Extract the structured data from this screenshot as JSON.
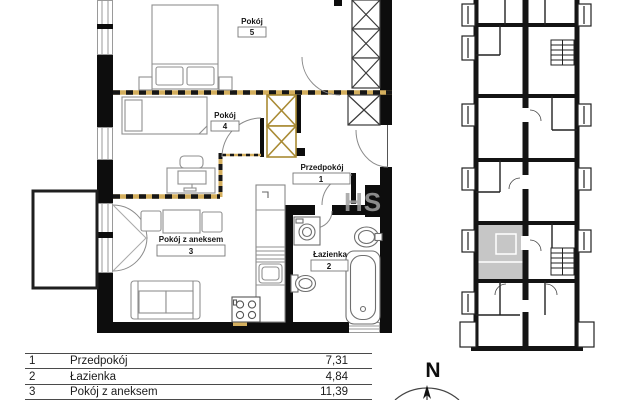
{
  "plan": {
    "rooms": [
      {
        "name": "Pokój",
        "number": "5"
      },
      {
        "name": "Pokój",
        "number": "4"
      },
      {
        "name": "Przedpokój",
        "number": "1"
      },
      {
        "name": "Pokój z aneksem",
        "number": "3"
      },
      {
        "name": "Łazienka",
        "number": "2"
      }
    ],
    "watermark": "HS"
  },
  "area_table": {
    "rows": [
      {
        "no": "1",
        "name": "Przedpokój",
        "area": "7,31"
      },
      {
        "no": "2",
        "name": "Łazienka",
        "area": "4,84"
      },
      {
        "no": "3",
        "name": "Pokój z aneksem",
        "area": "11,39"
      }
    ]
  },
  "compass": {
    "label": "N"
  },
  "colors": {
    "boundary": "#d4af5e",
    "wall": "#111111",
    "highlighted_unit": "#c6c6c6"
  }
}
